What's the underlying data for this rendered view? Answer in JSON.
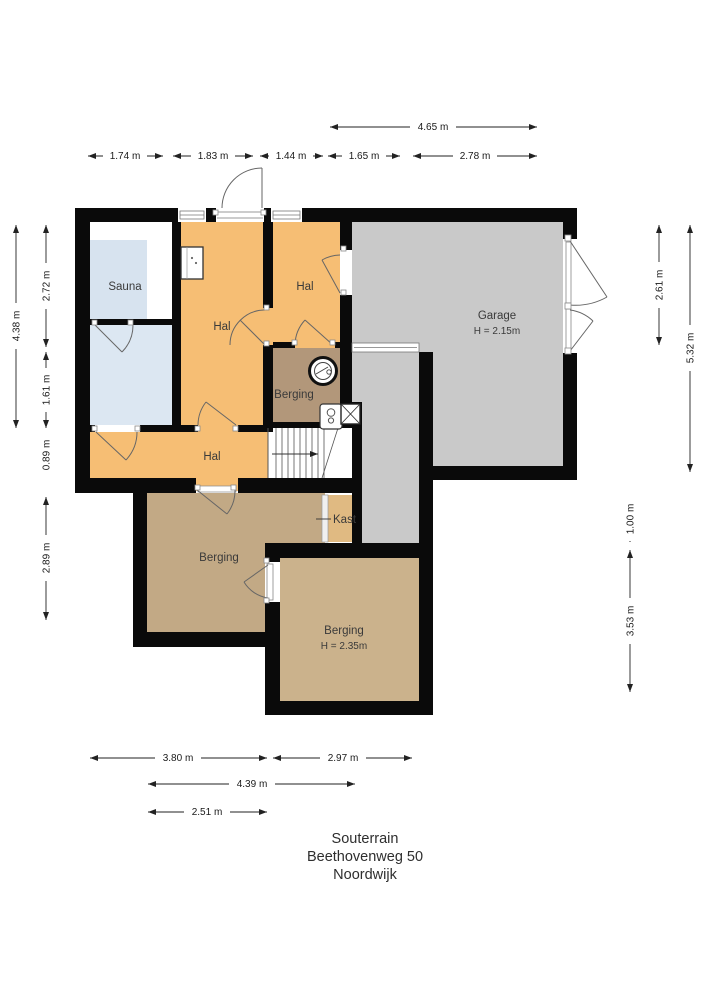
{
  "plan_title": {
    "floor": "Souterrain",
    "address": "Beethovenweg 50",
    "city": "Noordwijk"
  },
  "rooms": {
    "sauna": {
      "label": "Sauna"
    },
    "hal_main": {
      "label": "Hal"
    },
    "hal_top": {
      "label": "Hal"
    },
    "hal_lower": {
      "label": "Hal"
    },
    "garage": {
      "label": "Garage",
      "height_label": "H = 2.15m"
    },
    "berging_small": {
      "label": "Berging"
    },
    "berging_left": {
      "label": "Berging"
    },
    "berging_bottom": {
      "label": "Berging",
      "height_label": "H = 2.35m"
    },
    "kast": {
      "label": "Kast"
    }
  },
  "dimensions": {
    "top": [
      "4.65 m",
      "1.74 m",
      "1.83 m",
      "1.44 m",
      "1.65 m",
      "2.78 m"
    ],
    "left": [
      "4.38 m",
      "2.72 m",
      "1.61 m",
      "0.89 m",
      "2.89 m"
    ],
    "right": [
      "2.61 m",
      "5.32 m",
      "1.00 m",
      "3.53 m"
    ],
    "bottom": [
      "3.80 m",
      "2.97 m",
      "4.39 m",
      "2.51 m"
    ]
  },
  "colors": {
    "wall": "#0a0a0a",
    "hal_orange": "#F6BE74",
    "sauna_blue": "#D7E3EF",
    "room_blue": "#DCE7F2",
    "garage_gray": "#C9C9C9",
    "berging_small_brown": "#B2977A",
    "berging_left_brown": "#C2A985",
    "berging_bottom_tan": "#CBB28C",
    "kast_tan": "#E0BA82",
    "white": "#FFFFFF"
  },
  "icons": {
    "boiler": "boiler-circle-icon",
    "water_heater": "water-heater-icon",
    "appliance": "appliance-cabinet-icon",
    "shaft": "shaft-cross-icon",
    "stairs": "stairs-up-icon"
  }
}
